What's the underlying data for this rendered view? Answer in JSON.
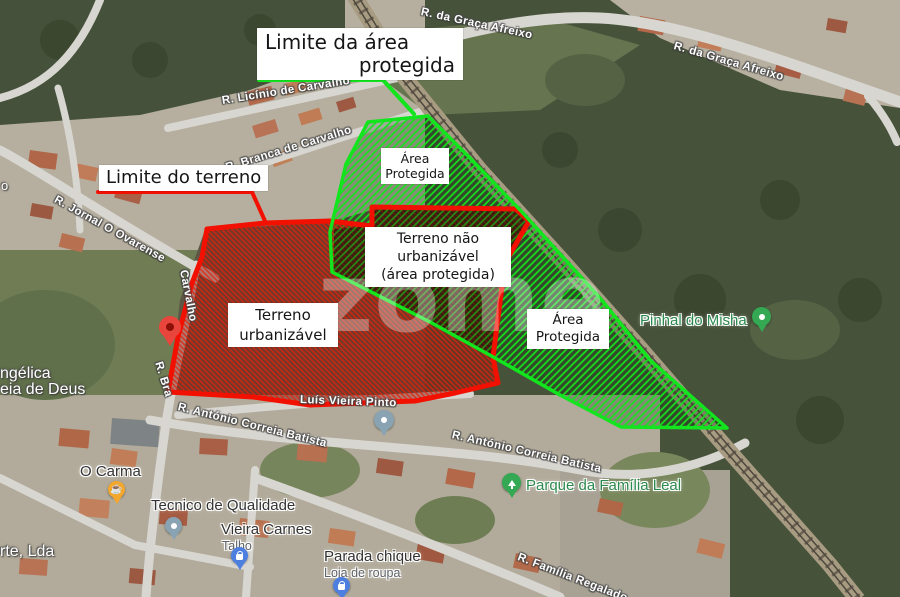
{
  "annotations": {
    "limite_area": [
      "Limite da área",
      "protegida"
    ],
    "limite_terreno": "Limite do terreno",
    "area_protegida": [
      "Área",
      "Protegida"
    ],
    "terreno_nao": [
      "Terreno não",
      "urbanizável",
      "(área protegida)"
    ],
    "terreno_urb": [
      "Terreno",
      "urbanizável"
    ]
  },
  "watermark": "zome",
  "legend_colors": {
    "protected_outline": "#12e41e",
    "terrain_outline": "#f21000"
  },
  "streets": [
    {
      "name": "R. da Graça Afreixo"
    },
    {
      "name": "R. da Graça Afreixo"
    },
    {
      "name": "R. Licínio de Carvalho"
    },
    {
      "name": "R. Branca de Carvalho"
    },
    {
      "name": "R. Jornal O Ovarense"
    },
    {
      "name": "Carvalho"
    },
    {
      "name": "R. Bra"
    },
    {
      "name": "Luís Vieira Pinto"
    },
    {
      "name": "R. António Correia Batista"
    },
    {
      "name": "R. António Correia Batista"
    },
    {
      "name": "R. Família Regalado"
    }
  ],
  "pois": [
    {
      "name": "O Carma",
      "pin": "coffee"
    },
    {
      "name": "Tecnico de Qualidade",
      "pin": "dot"
    },
    {
      "name": "Vieira Carnes",
      "sub": "Talho",
      "pin": "bag"
    },
    {
      "name": "Parada chique",
      "sub": "Loja de roupa",
      "pin": "bag"
    },
    {
      "name": "Parque da Família Leal",
      "pin": "tree"
    },
    {
      "name": "Pinhal do Misha",
      "pin": "walker"
    }
  ],
  "edge_labels": [
    "o",
    "ngélica",
    "eia de Deus",
    "rte, Lda"
  ],
  "icons": {
    "coffee": "☕"
  }
}
